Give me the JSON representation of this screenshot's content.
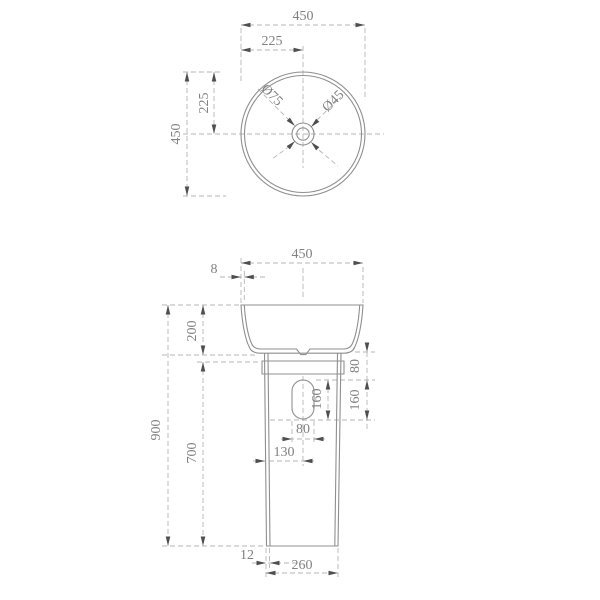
{
  "document": {
    "type": "technical-dimension-drawing",
    "subject": "Round freestanding pedestal wash basin",
    "units": "mm",
    "background_color": "#ffffff",
    "line_color": "#8f8f8f",
    "dim_line_color": "#b6b6b6",
    "text_color": "#818181",
    "arrow_color": "#4f4f4f"
  },
  "top_view": {
    "name": "basin-top-view",
    "overall_width": "450",
    "center_offset_x": "225",
    "overall_depth": "450",
    "center_offset_y": "225",
    "drain_outer_diameter": "Ø75",
    "drain_inner_diameter": "Ø45"
  },
  "front_view": {
    "name": "basin-front-view",
    "basin_width": "450",
    "rim_thickness": "8",
    "basin_height": "200",
    "overall_height": "900",
    "pedestal_height": "700",
    "basin_to_slot_gap": "80",
    "slot_height_right": "160",
    "slot_height_inner": "160",
    "slot_width": "80",
    "slot_center_from_edge": "130",
    "wall_thickness": "12",
    "pedestal_width": "260"
  },
  "labels": [
    {
      "text": "450"
    },
    {
      "text": "225"
    },
    {
      "text": "450"
    },
    {
      "text": "225"
    },
    {
      "text": "Ø75"
    },
    {
      "text": "Ø45"
    },
    {
      "text": "450"
    },
    {
      "text": "8"
    },
    {
      "text": "200"
    },
    {
      "text": "900"
    },
    {
      "text": "700"
    },
    {
      "text": "80"
    },
    {
      "text": "160"
    },
    {
      "text": "160"
    },
    {
      "text": "80"
    },
    {
      "text": "130"
    },
    {
      "text": "12"
    },
    {
      "text": "260"
    }
  ]
}
